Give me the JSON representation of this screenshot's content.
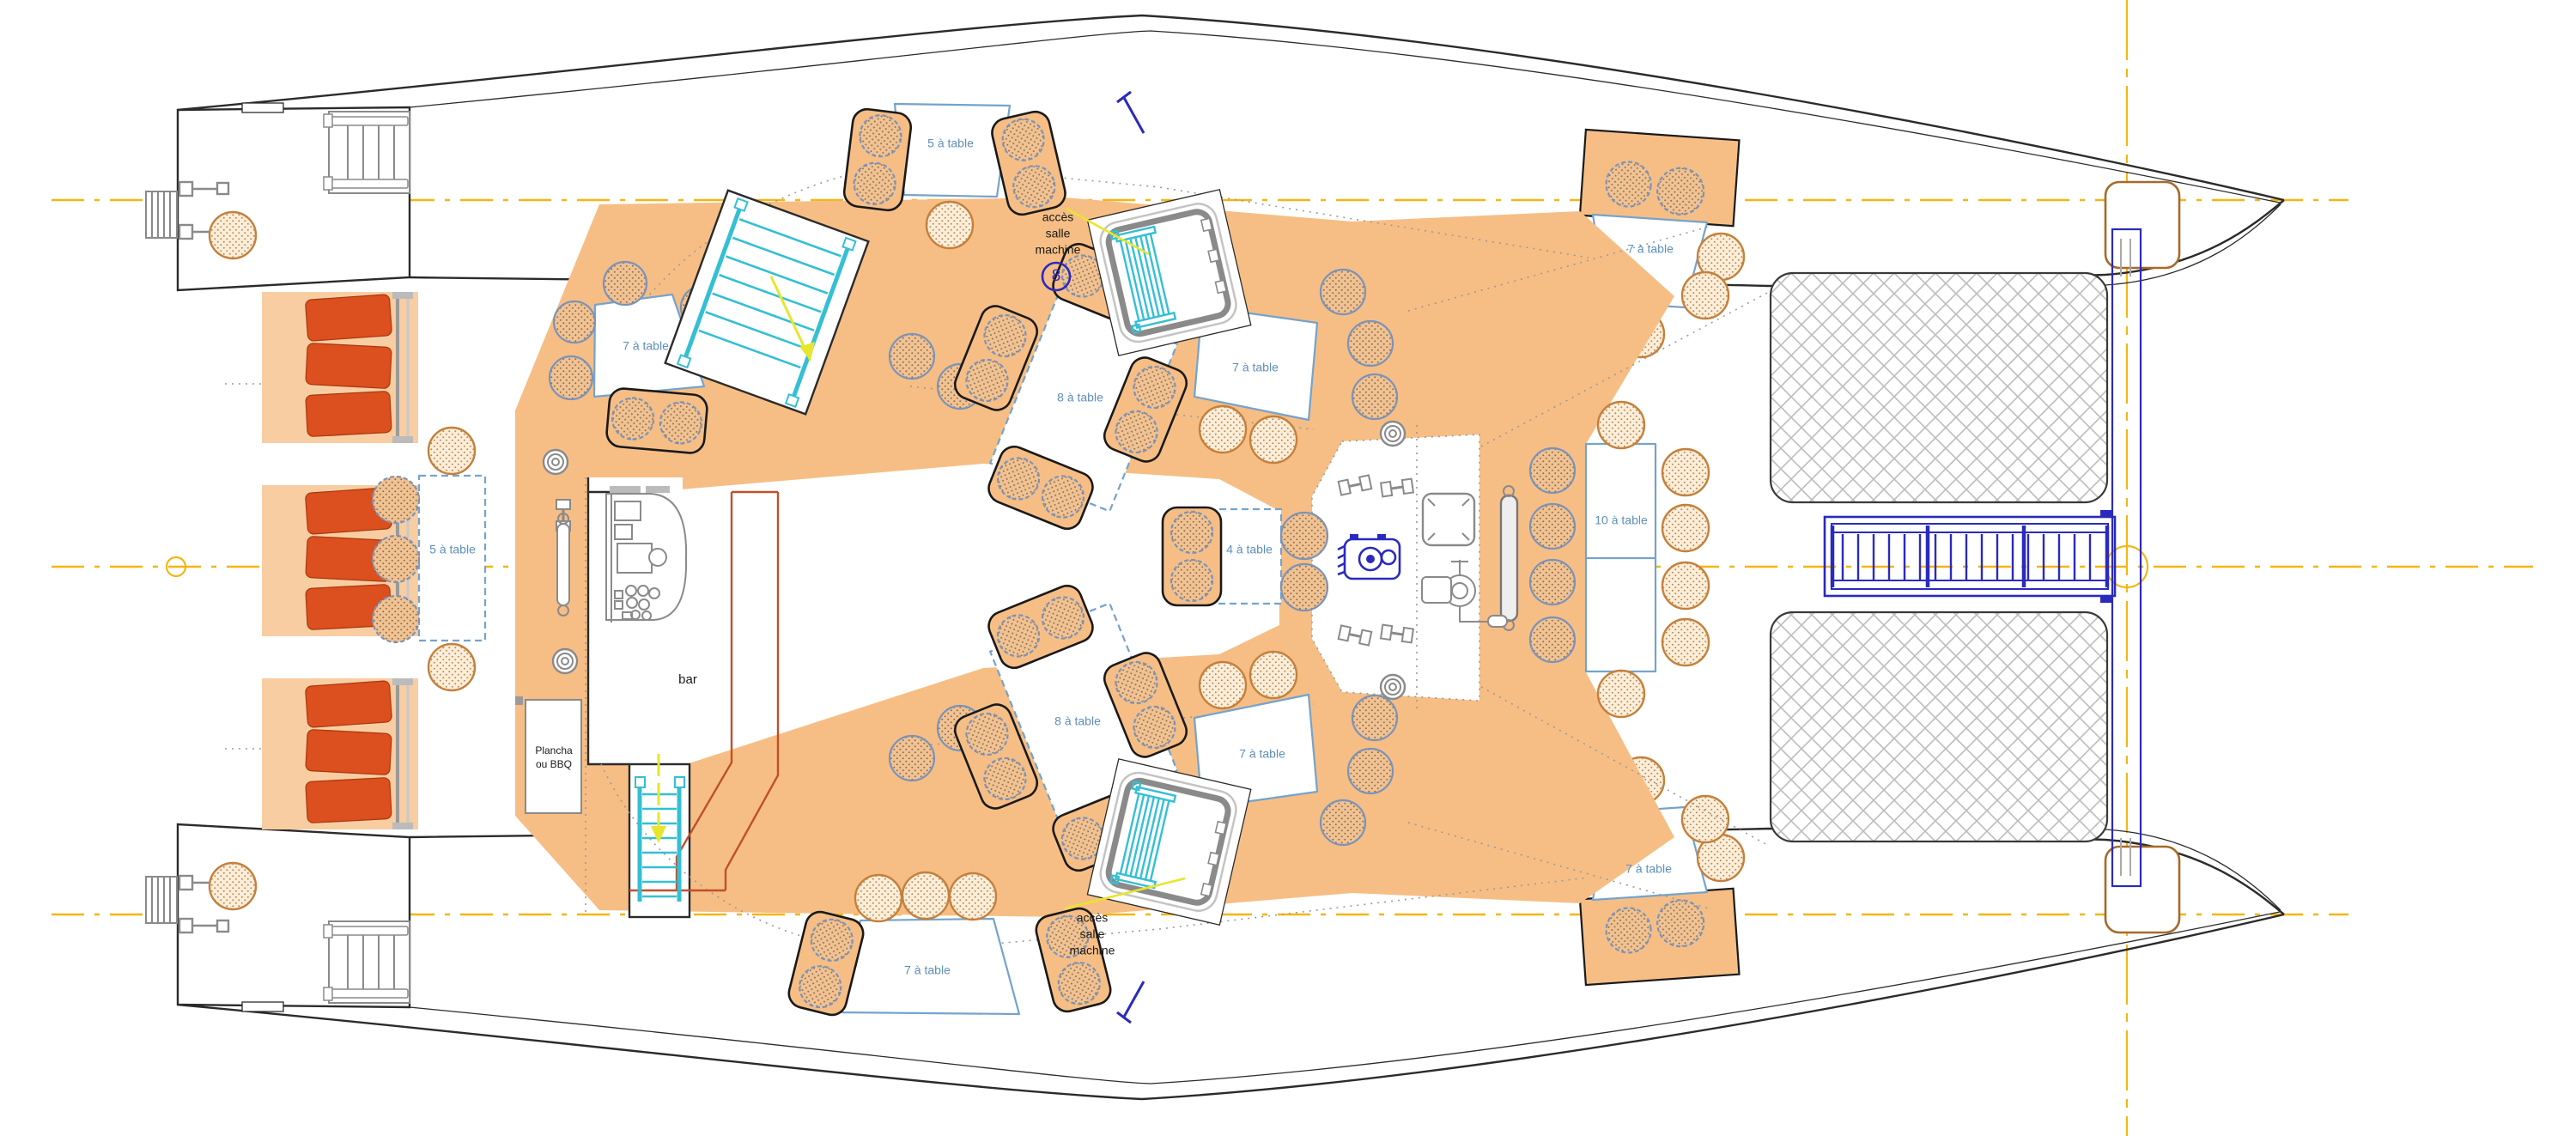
{
  "drawing": {
    "type": "catamaran-deck-plan",
    "description_visible_text_only": true
  },
  "labels": {
    "bar": "bar",
    "plancha": "Plancha\nou BBQ",
    "acces_machine": "accès\nsalle\nmachine",
    "circled_number": "8"
  },
  "tables": [
    {
      "id": "top-center",
      "label": "5 à table",
      "seats": 5
    },
    {
      "id": "left-lounge",
      "label": "5 à table",
      "seats": 5
    },
    {
      "id": "top-left",
      "label": "7 à table",
      "seats": 7
    },
    {
      "id": "upper-center-8",
      "label": "8 à table",
      "seats": 8
    },
    {
      "id": "upper-center-7",
      "label": "7 à table",
      "seats": 7
    },
    {
      "id": "center-4",
      "label": "4 à table",
      "seats": 4
    },
    {
      "id": "lower-center-8",
      "label": "8 à table",
      "seats": 8
    },
    {
      "id": "lower-center-7",
      "label": "7 à table",
      "seats": 7
    },
    {
      "id": "bottom-center",
      "label": "7 à table",
      "seats": 7
    },
    {
      "id": "top-right",
      "label": "7 à table",
      "seats": 7
    },
    {
      "id": "right-10",
      "label": "10 à table",
      "seats": 10
    },
    {
      "id": "bottom-right",
      "label": "7 à table",
      "seats": 7
    }
  ],
  "colors": {
    "deck": "#F6BE85",
    "deck_light": "#F8CDA2",
    "chair_fill": "#F1C292",
    "chair_fill_light": "#FBEEDA",
    "chair_stroke_blue": "#7A93B9",
    "chair_stroke_orange": "#C4803C",
    "table_stroke": "#74A3CC",
    "label_blue": "#5E8FBC",
    "cushion": "#DC4F1E",
    "centerline_yellow": "#F4B613",
    "arrow_yellow": "#E8E52E",
    "cyan": "#35BFD4",
    "blue": "#2A2ABF",
    "counter_red": "#C1502A",
    "hull": "#2B2B2B",
    "gray": "#8A8A8A",
    "hatch_gray": "#BDBDBD"
  }
}
